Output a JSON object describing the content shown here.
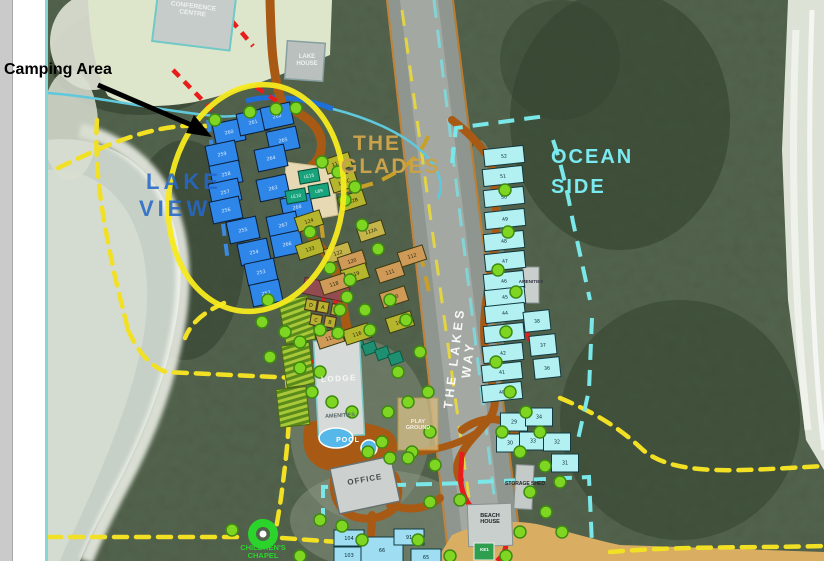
{
  "annotation": {
    "camping": "Camping Area"
  },
  "zones": {
    "lake_view": [
      "LAKE",
      "VIEW"
    ],
    "glades": [
      "THE",
      "GLADES"
    ],
    "ocean": [
      "OCEAN",
      "SIDE"
    ],
    "road": "THE LAKES WAY"
  },
  "places": {
    "conference": "CONFERENCE CENTRE",
    "lake_house": "LAKE HOUSE",
    "lodge": "LODGE",
    "lodge_amenities": "AMENITIES",
    "pool": "POOL",
    "office": "OFFICE",
    "playground": "PLAY GROUND",
    "ocean_amenities": "AMENITIES",
    "storage": "STORAGE SHED",
    "beach_house": "BEACH HOUSE",
    "chapel": "CHILDREN'S CHAPEL",
    "court": "KE1"
  },
  "palette": {
    "highlight_oval": "#f7ea1e",
    "annotation_text": "#000000",
    "lake_view_lots": "#2e86e8",
    "glades_lots_olive": "#b5b52e",
    "glades_lots_tan": "#cf9a58",
    "ocean_lots": "#b2f0f2",
    "roads_internal": "#a85a14",
    "trail_dashed": "#f2e024",
    "fire_trail_red": "#e81c1c",
    "tree_green": "#7fd622",
    "chapel_green": "#2bd42b"
  },
  "lots": {
    "lake_view": [
      {
        "n": "260",
        "x": 229,
        "y": 132
      },
      {
        "n": "261",
        "x": 253,
        "y": 122
      },
      {
        "n": "262",
        "x": 277,
        "y": 116
      },
      {
        "n": "259",
        "x": 222,
        "y": 154
      },
      {
        "n": "258",
        "x": 226,
        "y": 174
      },
      {
        "n": "257",
        "x": 225,
        "y": 192
      },
      {
        "n": "256",
        "x": 226,
        "y": 210
      },
      {
        "n": "255",
        "x": 243,
        "y": 230
      },
      {
        "n": "254",
        "x": 254,
        "y": 252
      },
      {
        "n": "253",
        "x": 261,
        "y": 272
      },
      {
        "n": "252",
        "x": 266,
        "y": 293
      },
      {
        "n": "265",
        "x": 283,
        "y": 140
      },
      {
        "n": "264",
        "x": 271,
        "y": 158
      },
      {
        "n": "263",
        "x": 273,
        "y": 188
      },
      {
        "n": "268",
        "x": 297,
        "y": 207
      },
      {
        "n": "267",
        "x": 283,
        "y": 225
      },
      {
        "n": "266",
        "x": 287,
        "y": 244
      }
    ],
    "lake_view_green": [
      {
        "n": "LE15",
        "x": 309,
        "y": 176
      },
      {
        "n": "LE10",
        "x": 296,
        "y": 196
      },
      {
        "n": "L69",
        "x": 319,
        "y": 191
      }
    ],
    "glades": [
      {
        "n": "112D",
        "x": 338,
        "y": 163,
        "c": "olive"
      },
      {
        "n": "112C",
        "x": 344,
        "y": 182,
        "c": "olive"
      },
      {
        "n": "112B",
        "x": 352,
        "y": 201,
        "c": "olive"
      },
      {
        "n": "112A",
        "x": 371,
        "y": 231,
        "c": "khaki"
      },
      {
        "n": "124",
        "x": 309,
        "y": 221,
        "c": "olive"
      },
      {
        "n": "133",
        "x": 310,
        "y": 249,
        "c": "olive"
      },
      {
        "n": "122",
        "x": 338,
        "y": 253,
        "c": "khaki"
      },
      {
        "n": "120",
        "x": 352,
        "y": 261,
        "c": "tan"
      },
      {
        "n": "119",
        "x": 355,
        "y": 274,
        "c": "olive"
      },
      {
        "n": "118",
        "x": 334,
        "y": 284,
        "c": "tan"
      },
      {
        "n": "112",
        "x": 412,
        "y": 256,
        "c": "tan"
      },
      {
        "n": "111",
        "x": 390,
        "y": 272,
        "c": "tan"
      },
      {
        "n": "110",
        "x": 394,
        "y": 297,
        "c": "tan"
      },
      {
        "n": "109",
        "x": 400,
        "y": 322,
        "c": "olive"
      },
      {
        "n": "116",
        "x": 357,
        "y": 334,
        "c": "olive"
      },
      {
        "n": "115",
        "x": 330,
        "y": 338,
        "c": "tan"
      }
    ],
    "ocean": [
      {
        "n": "52",
        "x": 504,
        "y": 156
      },
      {
        "n": "51",
        "x": 503,
        "y": 176
      },
      {
        "n": "50",
        "x": 504,
        "y": 197
      },
      {
        "n": "49",
        "x": 505,
        "y": 219
      },
      {
        "n": "48",
        "x": 504,
        "y": 241
      },
      {
        "n": "47",
        "x": 505,
        "y": 261
      },
      {
        "n": "46",
        "x": 504,
        "y": 281
      },
      {
        "n": "45",
        "x": 505,
        "y": 297
      },
      {
        "n": "44",
        "x": 505,
        "y": 313
      },
      {
        "n": "43",
        "x": 504,
        "y": 333
      },
      {
        "n": "42",
        "x": 503,
        "y": 353
      },
      {
        "n": "41",
        "x": 502,
        "y": 372
      },
      {
        "n": "40",
        "x": 502,
        "y": 392
      },
      {
        "n": "38",
        "x": 537,
        "y": 321,
        "w": 26,
        "h": 20
      },
      {
        "n": "37",
        "x": 543,
        "y": 345,
        "w": 26,
        "h": 20
      },
      {
        "n": "36",
        "x": 547,
        "y": 368,
        "w": 26,
        "h": 20
      }
    ],
    "ocean_lower": [
      {
        "n": "29",
        "x": 514,
        "y": 422
      },
      {
        "n": "34",
        "x": 539,
        "y": 417
      },
      {
        "n": "30",
        "x": 510,
        "y": 443
      },
      {
        "n": "33",
        "x": 533,
        "y": 441
      },
      {
        "n": "32",
        "x": 557,
        "y": 442
      },
      {
        "n": "31",
        "x": 565,
        "y": 463
      }
    ],
    "south": [
      {
        "n": "104",
        "x": 349,
        "y": 538
      },
      {
        "n": "103",
        "x": 349,
        "y": 555
      },
      {
        "n": "66",
        "x": 382,
        "y": 550,
        "w": 42,
        "h": 26
      },
      {
        "n": "91",
        "x": 409,
        "y": 537
      },
      {
        "n": "65",
        "x": 426,
        "y": 557
      }
    ],
    "cabins": [
      {
        "n": "D",
        "x": 311,
        "y": 305
      },
      {
        "n": "A",
        "x": 323,
        "y": 307
      },
      {
        "n": "E",
        "x": 337,
        "y": 310
      },
      {
        "n": "C",
        "x": 316,
        "y": 320
      },
      {
        "n": "B",
        "x": 330,
        "y": 322
      }
    ]
  },
  "trees": [
    [
      215,
      120
    ],
    [
      250,
      112
    ],
    [
      276,
      109
    ],
    [
      296,
      108
    ],
    [
      322,
      162
    ],
    [
      338,
      172
    ],
    [
      355,
      187
    ],
    [
      310,
      232
    ],
    [
      330,
      268
    ],
    [
      347,
      297
    ],
    [
      268,
      300
    ],
    [
      262,
      322
    ],
    [
      285,
      332
    ],
    [
      300,
      342
    ],
    [
      320,
      330
    ],
    [
      338,
      333
    ],
    [
      270,
      357
    ],
    [
      300,
      368
    ],
    [
      320,
      372
    ],
    [
      345,
      200
    ],
    [
      362,
      225
    ],
    [
      378,
      249
    ],
    [
      350,
      280
    ],
    [
      365,
      310
    ],
    [
      340,
      310
    ],
    [
      390,
      300
    ],
    [
      406,
      320
    ],
    [
      370,
      330
    ],
    [
      420,
      352
    ],
    [
      398,
      372
    ],
    [
      428,
      392
    ],
    [
      408,
      402
    ],
    [
      388,
      412
    ],
    [
      430,
      432
    ],
    [
      412,
      452
    ],
    [
      382,
      442
    ],
    [
      352,
      412
    ],
    [
      332,
      402
    ],
    [
      312,
      392
    ],
    [
      368,
      452
    ],
    [
      390,
      458
    ],
    [
      408,
      458
    ],
    [
      435,
      465
    ],
    [
      505,
      190
    ],
    [
      508,
      232
    ],
    [
      498,
      270
    ],
    [
      516,
      292
    ],
    [
      506,
      332
    ],
    [
      496,
      362
    ],
    [
      510,
      392
    ],
    [
      526,
      412
    ],
    [
      540,
      432
    ],
    [
      502,
      432
    ],
    [
      520,
      452
    ],
    [
      545,
      466
    ],
    [
      560,
      482
    ],
    [
      530,
      492
    ],
    [
      546,
      512
    ],
    [
      562,
      532
    ],
    [
      520,
      532
    ],
    [
      506,
      556
    ],
    [
      460,
      500
    ],
    [
      430,
      502
    ],
    [
      418,
      540
    ],
    [
      450,
      556
    ],
    [
      320,
      520
    ],
    [
      342,
      526
    ],
    [
      362,
      540
    ],
    [
      300,
      556
    ],
    [
      232,
      530
    ]
  ]
}
